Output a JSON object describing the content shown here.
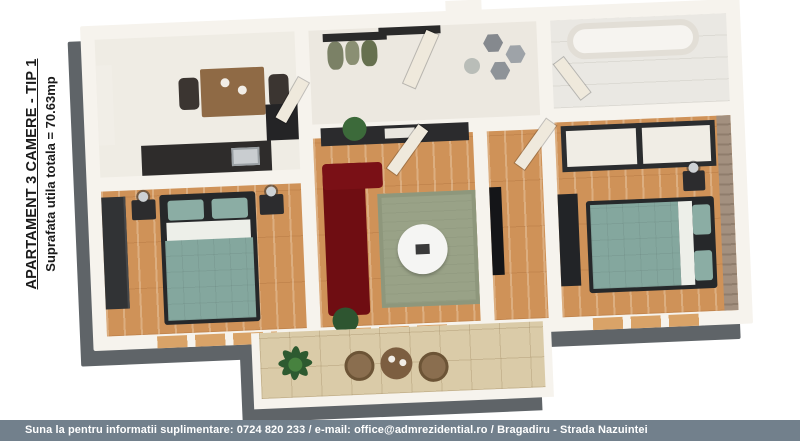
{
  "sidebar": {
    "title": "APARTAMENT 3 CAMERE - TIP 1",
    "subtitle": "Suprafata utila totala = 70.63mp"
  },
  "footer": {
    "text": "Suna la pentru informatii suplimentare: 0724 820 233 / e-mail: office@admrezidential.ro  / Bragadiru - Strada Nazuintei"
  },
  "plan": {
    "palette": {
      "wall": "#f6f3ed",
      "wall_side_shadow": "#5f6468",
      "wood_floor": "#cf9258",
      "kitchen_floor": "#efece4",
      "bathroom_floor": "#eae8e3",
      "balcony_floor": "#dacba8",
      "bed_duvet_teal": "#84a79e",
      "sofa_red": "#6f0d12",
      "rug_green": "#99a287",
      "furniture_dark": "#2b2d2f",
      "brick_accent": "#a3907f",
      "footer_bar": "#72808c"
    }
  }
}
